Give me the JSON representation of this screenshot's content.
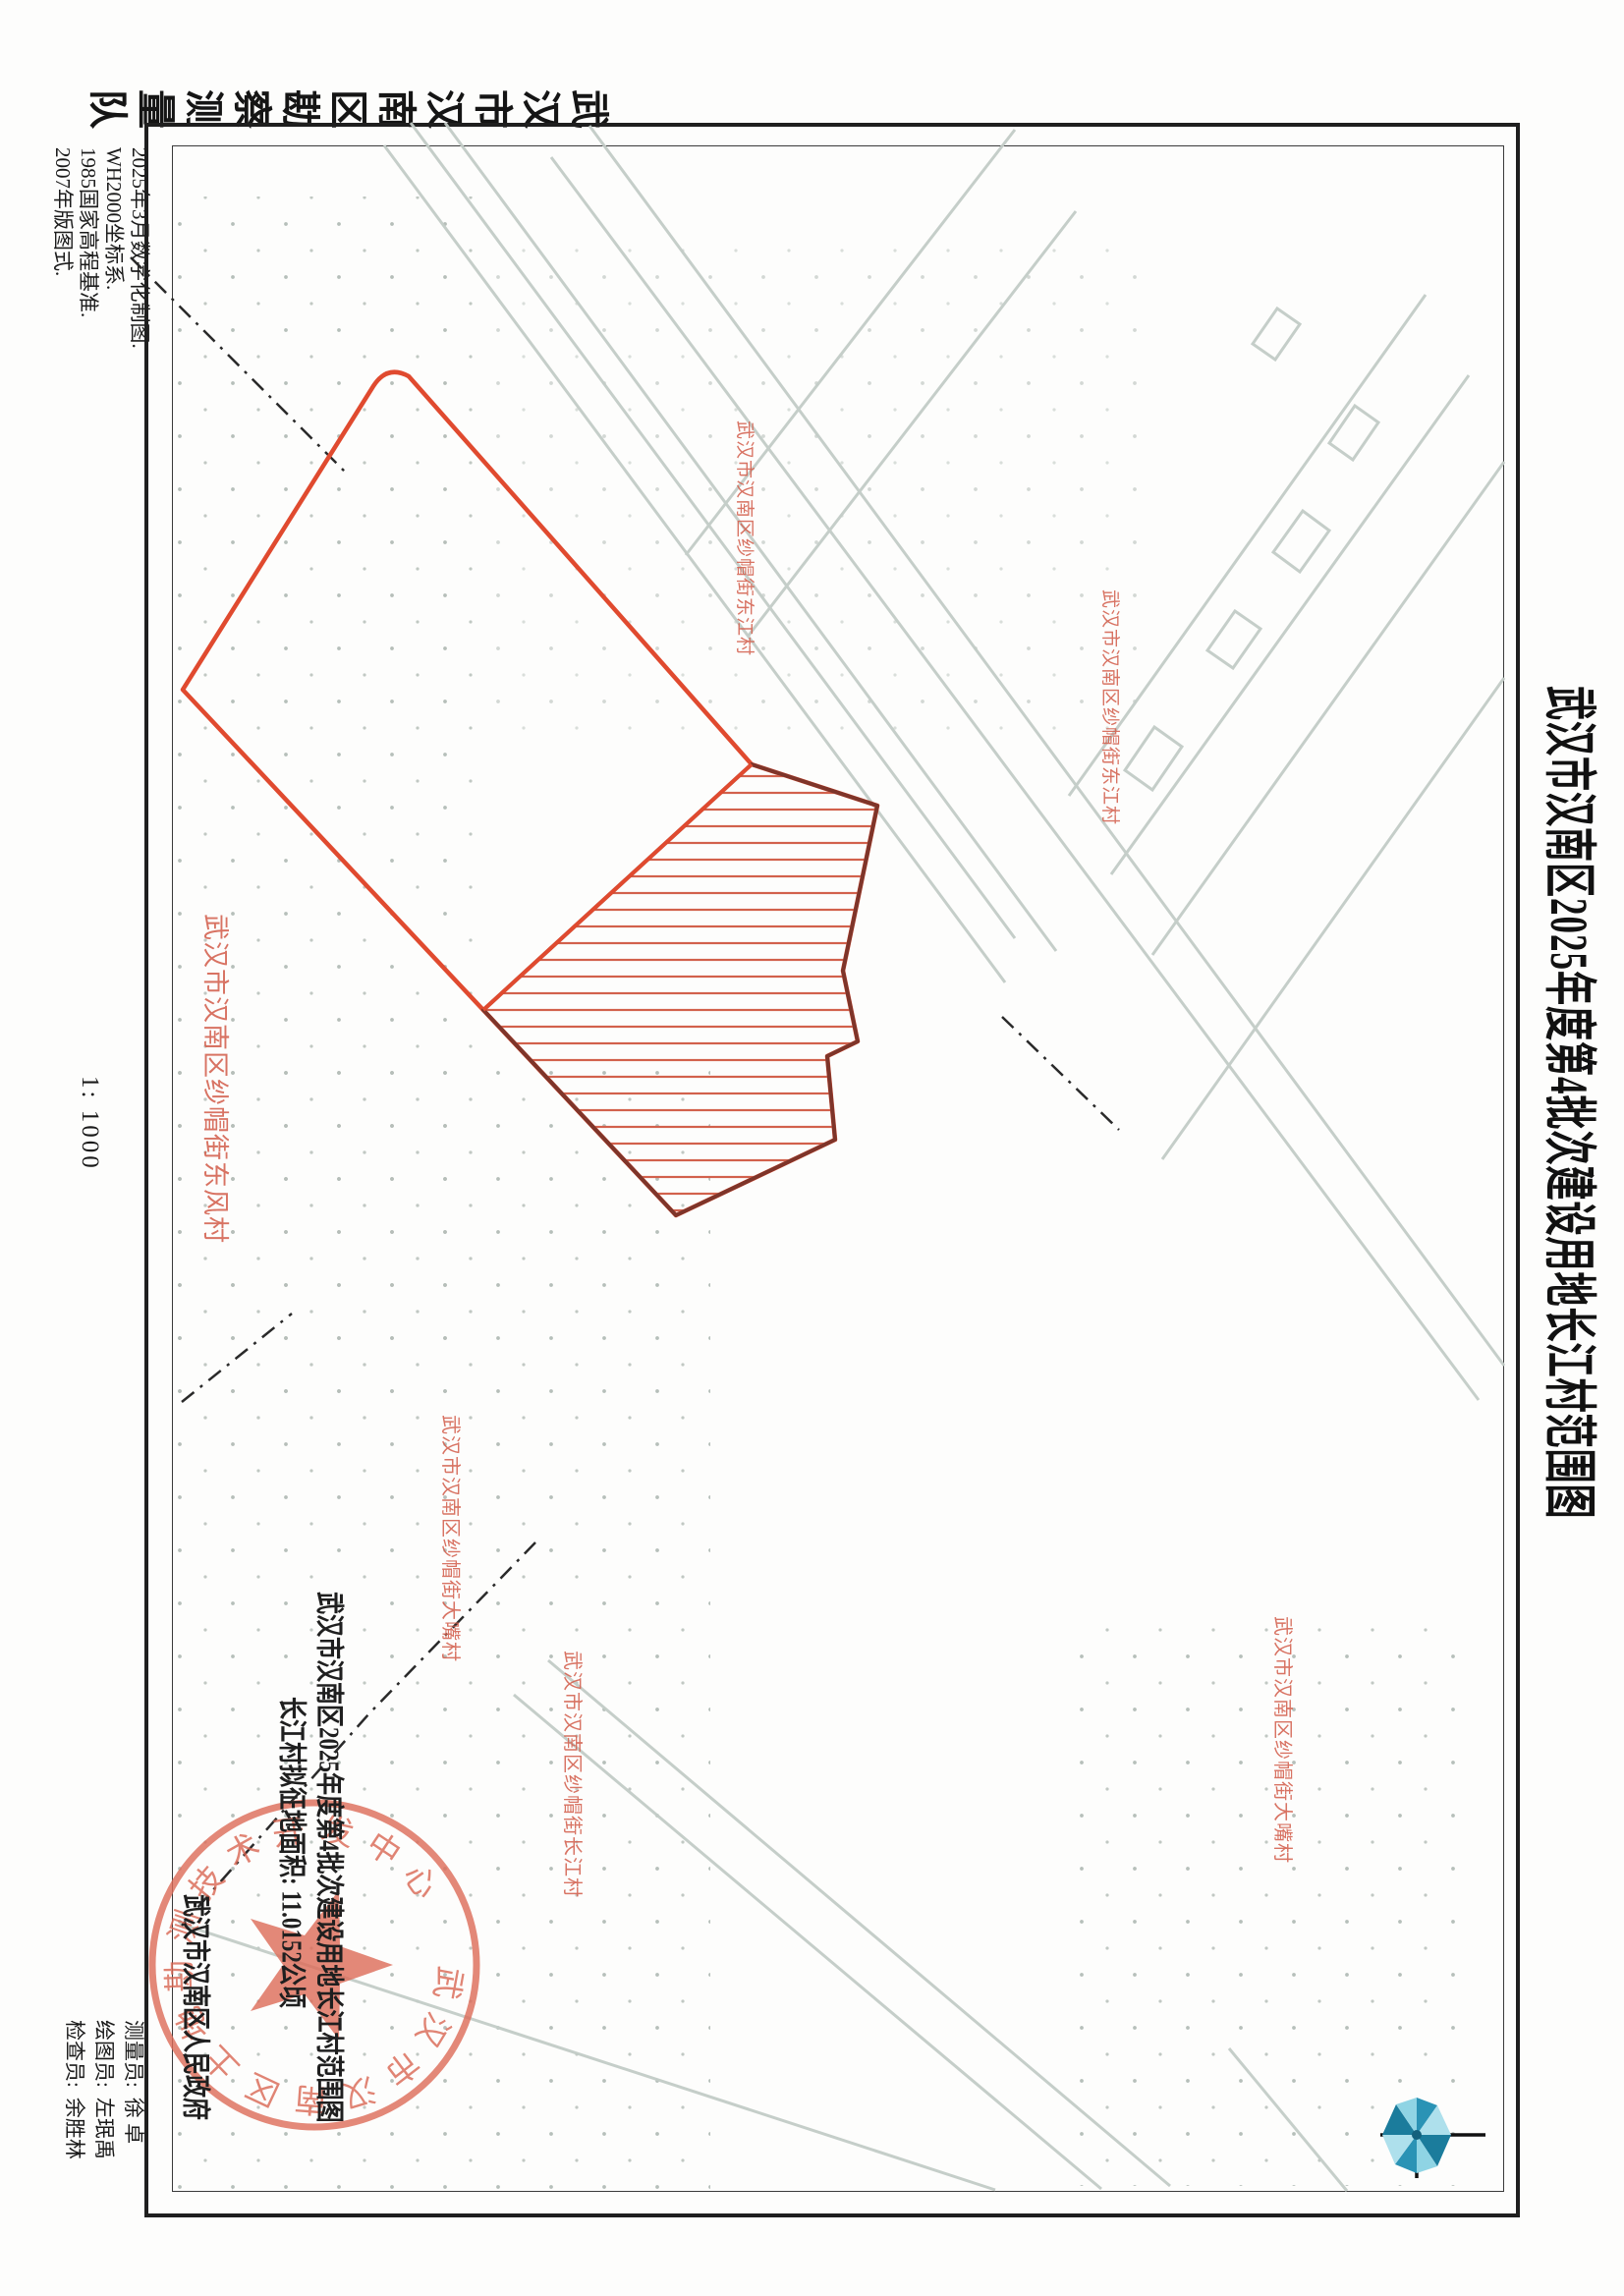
{
  "sheet": {
    "title": "武汉市汉南区2025年度第4批次建设用地长江村范围图",
    "agency_vertical": "武汉市汉南区勘察测量队",
    "scale": "1: 1000",
    "notes": [
      "2025年3月数字化制图.",
      "WH2000坐标系.",
      "1985国家高程基准.",
      "2007年版图式."
    ],
    "credits": [
      {
        "label": "测量员:",
        "name": "徐  卓"
      },
      {
        "label": "绘图员:",
        "name": "左珉禹"
      },
      {
        "label": "检查员:",
        "name": "余胜林"
      }
    ]
  },
  "map": {
    "announcement": {
      "line1": "武汉市汉南区2025年度第4批次建设用地长江村范围图",
      "line2": "长江村拟征地面积: 11.0152公顷",
      "government": "武汉市汉南区人民政府"
    },
    "seal_text": "武汉市汉南区土地勘测技术开发中心",
    "villages": [
      {
        "text": "武汉市汉南区纱帽街东江村"
      },
      {
        "text": "武汉市汉南区纱帽街东江村"
      },
      {
        "text": "武汉市汉南区纱帽街东风村"
      },
      {
        "text": "武汉市汉南区纱帽街大嘴村"
      },
      {
        "text": "武汉市汉南区纱帽街长江村"
      },
      {
        "text": "武汉市汉南区纱帽街大嘴村"
      }
    ],
    "colors": {
      "parcel_red": "#e04a2f",
      "hatch_line_red": "#d2614c",
      "hatch_border": "#7e352a",
      "label_red": "#d4604e",
      "seal_red": "#dd6b58",
      "street_gray": "#c3ccc7",
      "boundary_black": "#2a2a2a",
      "compass_teal": "#2a93b5"
    }
  }
}
